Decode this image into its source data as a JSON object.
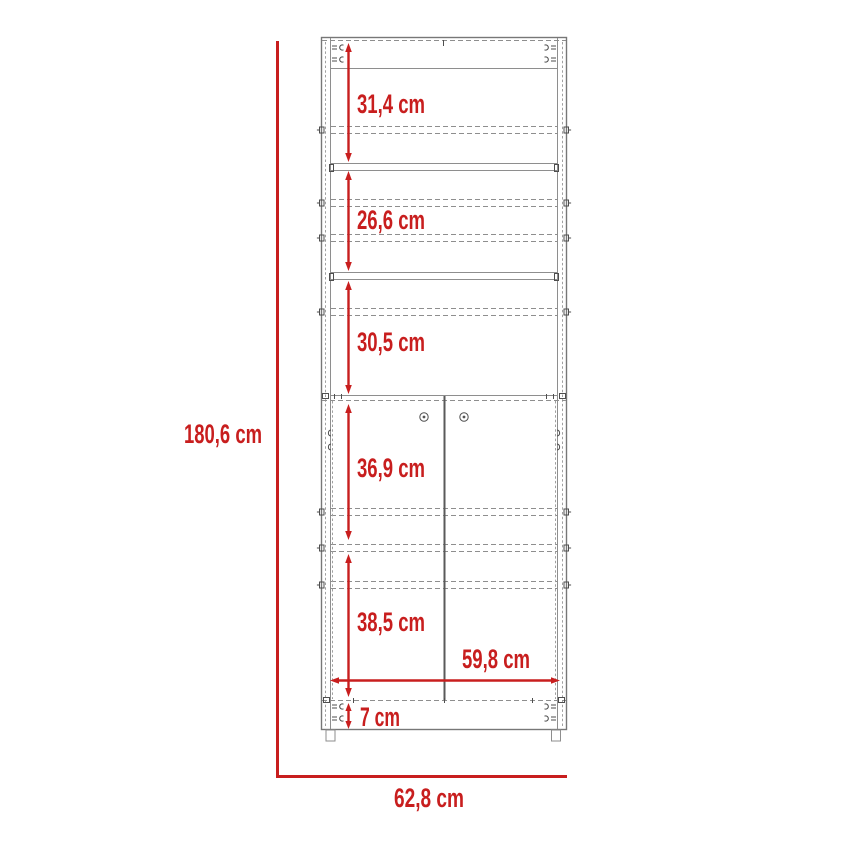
{
  "diagram": {
    "kind": "furniture-dimension-drawing",
    "subject": "tall cabinet with shelves and double doors, front elevation",
    "unit": "cm",
    "colors": {
      "dimension_red": "#c81e1e",
      "outline_gray": "#8e8e8e",
      "detail_dark": "#4e4e4e",
      "background": "#ffffff"
    },
    "overall_height": {
      "label": "180,6 cm"
    },
    "overall_width": {
      "label": "62,8 cm"
    },
    "door_width": {
      "label": "59,8 cm"
    },
    "sections": [
      {
        "name": "top-shelf-space",
        "label": "31,4 cm"
      },
      {
        "name": "second-shelf-space",
        "label": "26,6 cm"
      },
      {
        "name": "third-shelf-space",
        "label": "30,5 cm"
      },
      {
        "name": "upper-door-space",
        "label": "36,9 cm"
      },
      {
        "name": "lower-door-space",
        "label": "38,5 cm"
      },
      {
        "name": "plinth-height",
        "label": "7 cm"
      }
    ]
  }
}
